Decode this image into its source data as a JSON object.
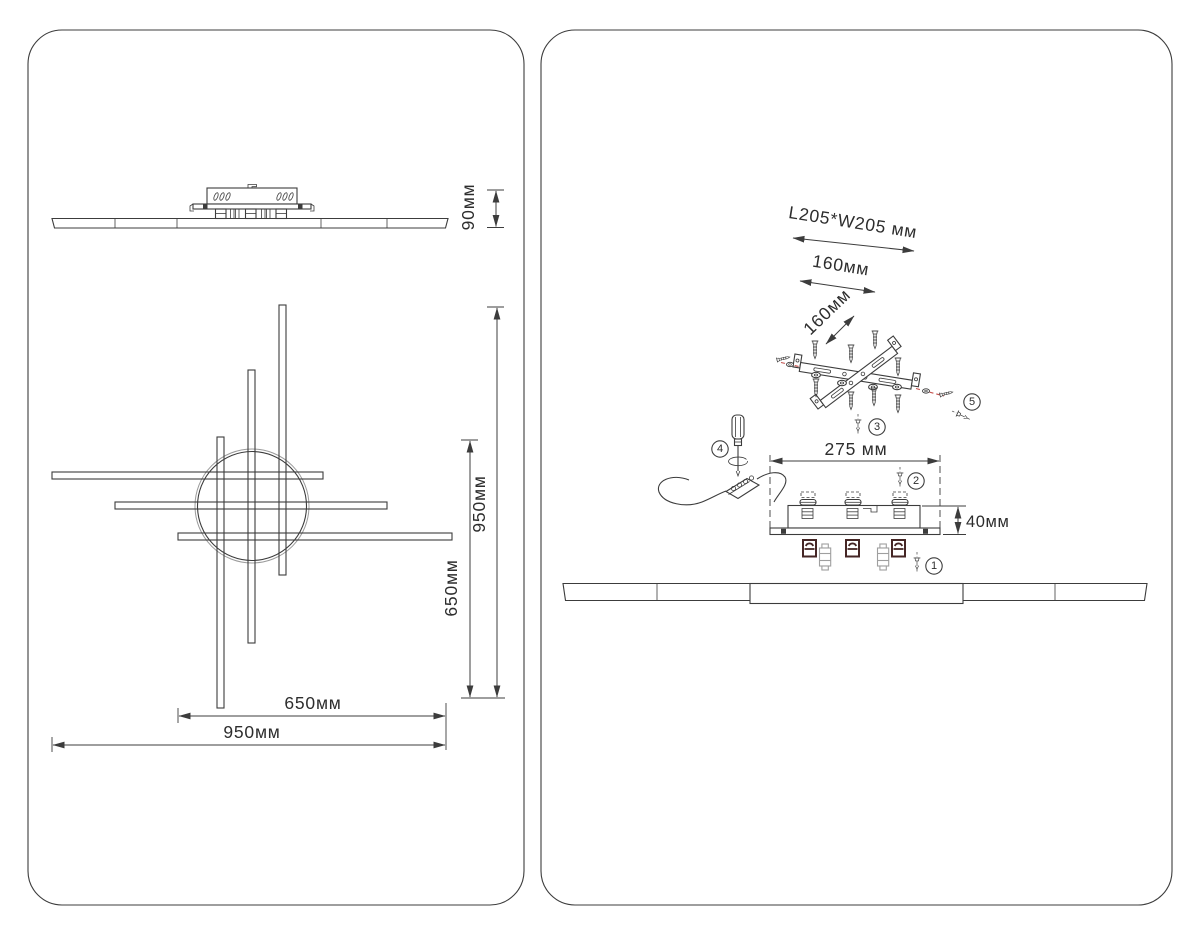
{
  "colors": {
    "background": "#ffffff",
    "line": "#3c3c3c",
    "text": "#2d2d2d",
    "accent_red": "#c4504c",
    "clip_dark": "#452625"
  },
  "left_panel": {
    "side_view": {
      "height_dim": "90мм"
    },
    "top_view": {
      "overall_height_dim": "950мм",
      "rod_vertical_dim": "650мм",
      "rod_horizontal_dim": "650мм",
      "overall_width_dim": "950мм"
    }
  },
  "right_panel": {
    "mount_plate": {
      "plate_size_dim": "L205*W205 мм",
      "hole_spacing_dim": "160мм",
      "hole_spacing_dim_2": "160мм"
    },
    "driver_box": {
      "width_dim": "275 мм",
      "height_dim": "40мм"
    },
    "callouts": {
      "step1": "1",
      "step2": "2",
      "step3": "3",
      "step4": "4",
      "step5": "5"
    }
  }
}
